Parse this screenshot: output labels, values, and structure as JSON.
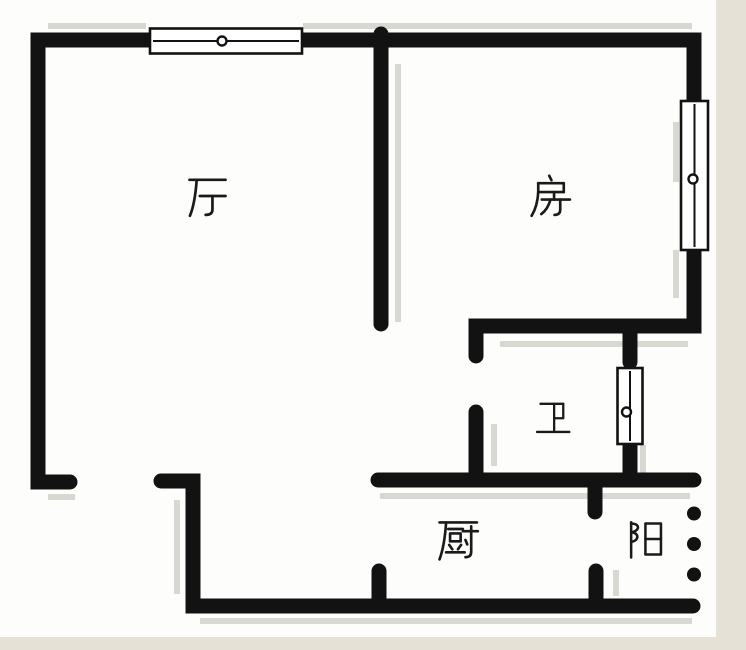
{
  "plan": {
    "type": "apartment floor plan",
    "rooms": {
      "living": "厅",
      "bedroom": "房",
      "bathroom": "卫",
      "kitchen": "厨",
      "balcony": "阳"
    }
  },
  "icons": {
    "window": "rectangle with center rail line and pivot circle",
    "balcony_opening": "three round dots marking open railing edge"
  },
  "counts": {
    "windows": 3,
    "balcony_dots": 3
  },
  "colors": {
    "wall": "#121212",
    "shadow": "#d8d7d2",
    "edge_strip": "#e6e1d7",
    "background": "#fdfdfc",
    "window_fill": "#ffffff",
    "glyph": "#1a1a1a"
  }
}
